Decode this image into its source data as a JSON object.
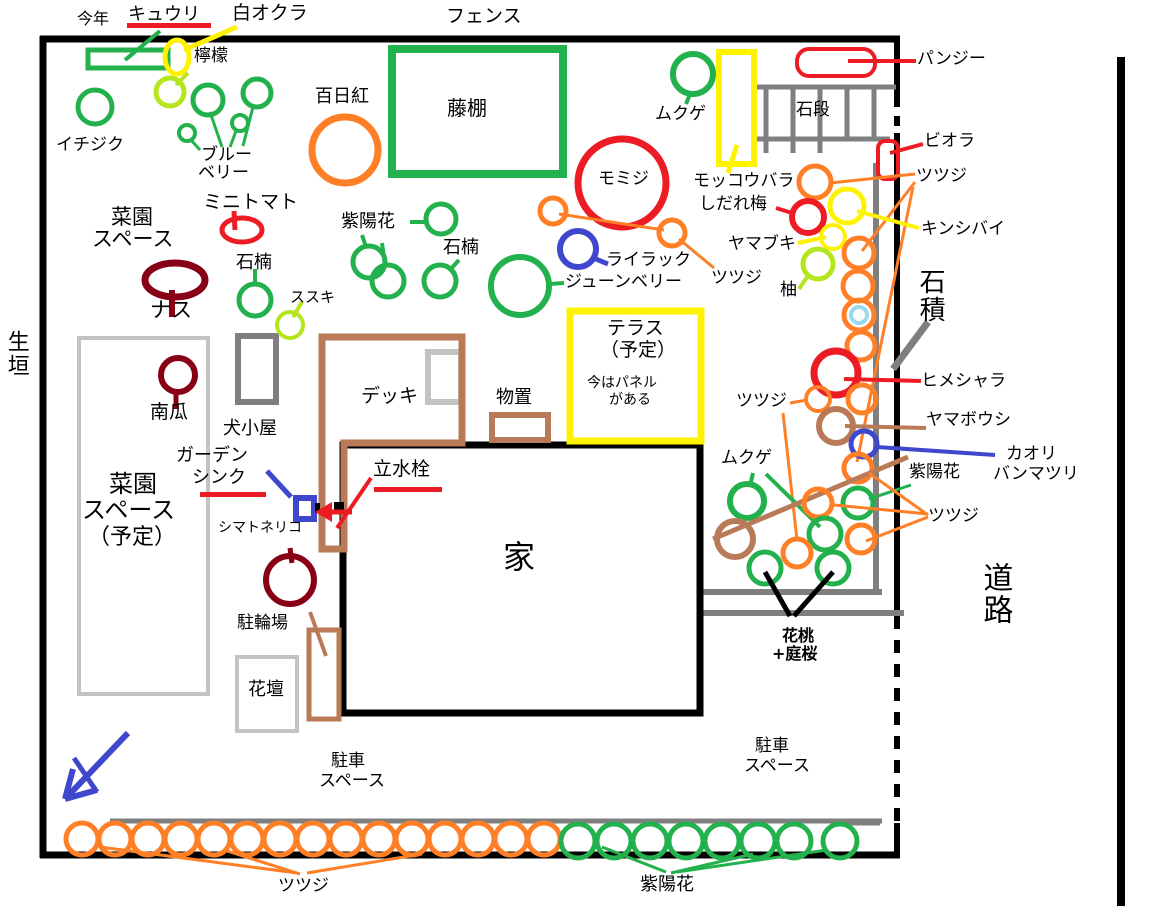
{
  "labels": {
    "kotoshi": "今年",
    "kyuri": "キュウリ",
    "shiro_okura": "白オクラ",
    "fence": "フェンス",
    "remon": "檸檬",
    "ichijiku": "イチジク",
    "blueberry_1": "ブルー",
    "blueberry_2": "ベリー",
    "sarusuberi": "百日紅",
    "fujidana": "藤棚",
    "mukuge_top": "ムクゲ",
    "mokkoubara": "モッコウバラ",
    "shidareume": "しだれ梅",
    "yamabuki": "ヤマブキ",
    "yuzu": "柚",
    "ishidan": "石段",
    "pansy": "パンジー",
    "viola": "ビオラ",
    "tsutsuji_right_top": "ツツジ",
    "kinshibai": "キンシバイ",
    "ishizumi": "石積",
    "himeshara": "ヒメシャラ",
    "yamaboushi": "ヤマボウシ",
    "kaori_1": "カオリ",
    "kaori_2": "バンマツリ",
    "ajisai_right": "紫陽花",
    "tsutsuji_right_low": "ツツジ",
    "douro": "道路",
    "ikegaki": "生垣",
    "momiji": "モミジ",
    "lilac": "ライラック",
    "juneberry": "ジューンベリー",
    "tsutsuji_mid1": "ツツジ",
    "tsutsuji_mid2": "ツツジ",
    "ajisai_mid": "紫陽花",
    "shakunage_mid": "石楠",
    "susuki": "ススキ",
    "saien_1": "菜園",
    "saien_2": "スペース",
    "minitomato": "ミニトマト",
    "nasu": "ナス",
    "shakunage_left": "石楠",
    "kabocha": "南瓜",
    "inugoya": "犬小屋",
    "saien_plan_1": "菜園",
    "saien_plan_2": "スペース",
    "saien_plan_3": "（予定）",
    "garden_sink_1": "ガーデン",
    "garden_sink_2": "シンク",
    "shimatoneriko": "シマトネリコ",
    "churinjo": "駐輪場",
    "kadan": "花壇",
    "deck": "デッキ",
    "monooki": "物置",
    "rissuisen": "立水栓",
    "ie": "家",
    "terrace_1": "テラス",
    "terrace_2": "（予定）",
    "terrace_3": "今はパネル",
    "terrace_4": "がある",
    "hanamomo_1": "花桃",
    "hanamomo_2": "+庭桜",
    "chusha_left_1": "駐車",
    "chusha_left_2": "スペース",
    "chusha_right_1": "駐車",
    "chusha_right_2": "スペース",
    "tsutsuji_bottom": "ツツジ",
    "ajisai_bottom": "紫陽花",
    "mukuge_low": "ムクゲ"
  },
  "colors": {
    "green": "#22B14C",
    "orange": "#FF7F27",
    "red": "#ED1C24",
    "yellow": "#FFF200",
    "lime": "#B5E61D",
    "dark_red": "#880015",
    "brown": "#B97A57",
    "blue": "#3F48CC",
    "light_blue": "#99D9EA",
    "gray": "#7F7F7F",
    "light_gray": "#C3C3C3",
    "black": "#000000"
  }
}
